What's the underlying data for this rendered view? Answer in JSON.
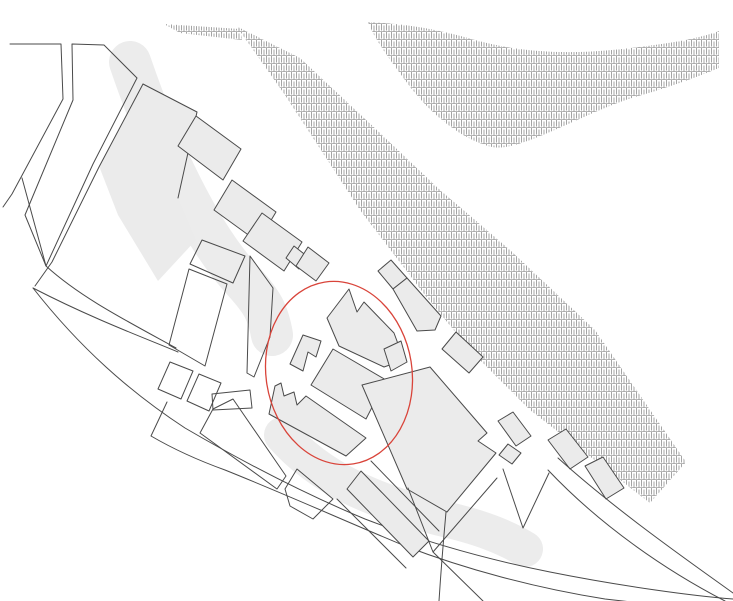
{
  "figure": {
    "kind": "architectural-site-plan",
    "canvas": {
      "width": 733,
      "height": 601
    },
    "colors": {
      "background": "#ffffff",
      "line": "#4a4a4a",
      "building_fill": "#ebebeb",
      "swath_fill": "#ececec",
      "hatch_stroke": "#8e8e8e",
      "hatch_row_stroke": "#9a9a9a",
      "highlight_stroke": "#d9443a"
    },
    "highlight_ellipse": {
      "cx": 339,
      "cy": 373,
      "rx": 73,
      "ry": 92,
      "rotation": -9
    },
    "shapes": [
      {
        "name": "soft-gray-swath-upper",
        "kind": "swath",
        "w": 42,
        "d": "M130,62 C160,150 200,235 245,283 C262,302 268,312 272,335"
      },
      {
        "name": "soft-gray-swath-lower",
        "kind": "swath",
        "w": 36,
        "d": "M282,435 C320,478 370,500 440,518 C480,527 505,537 525,549"
      },
      {
        "name": "gray-triangle-area",
        "kind": "shade",
        "d": "M143,84 L197,112 L178,198 L196,240 L158,281 L118,215 L99,166 Z"
      },
      {
        "name": "hatch-river-leaf",
        "kind": "hatch",
        "d": "M368,22 C410,24 440,30 475,40 C515,51 560,55 612,50 C660,45 695,40 719,31 L719,68 C690,80 660,90 635,97 C605,106 570,124 538,137 C515,146 500,150 488,146 C455,136 425,108 405,80 C390,60 375,40 368,22 Z"
      },
      {
        "name": "hatch-embankment-band",
        "kind": "hatch",
        "d": "M237,27 L285,95 L360,210 L425,295 L470,350 L530,410 L650,503 L686,462 L595,330 L510,250 L440,190 L380,133 L300,58 L240,28 Z"
      },
      {
        "name": "hatch-embankment-wisp",
        "kind": "hatch",
        "d": "M164,24 L240,29 L242,40 L180,33 Z"
      },
      {
        "name": "street-edge-topleft",
        "kind": "line",
        "d": "M10,44 L61,44 L63,99 L12,194 L3,207"
      },
      {
        "name": "block-topleft",
        "kind": "block",
        "d": "M72,44 L104,45 L137,78 L93,164 L46,266 L25,215 L73,100 Z"
      },
      {
        "name": "street-edge-diagonal-inner",
        "kind": "line",
        "d": "M143,84 L99,167 L52,262 L35,286"
      },
      {
        "name": "street-edge-gray-triangle",
        "kind": "line",
        "d": "M143,84 L197,112 L178,198"
      },
      {
        "name": "street-edge-crescent-north",
        "kind": "line",
        "d": "M22,178 L46,266 C80,297 125,320 176,348"
      },
      {
        "name": "crescent-top-edge",
        "kind": "line",
        "d": "M33,288 C95,320 150,340 178,352"
      },
      {
        "name": "district-outer-curve",
        "kind": "line",
        "d": "M33,288 C80,348 130,392 185,428 C245,463 305,494 365,519 C425,542 490,560 550,572 C620,586 693,596 733,599"
      },
      {
        "name": "curved-street-south-edge",
        "kind": "line",
        "d": "M167,402 L151,436 C175,450 200,461 225,470 C285,494 345,521 405,546 C465,569 535,588 605,599 L658,605"
      },
      {
        "name": "block-small-a",
        "kind": "block",
        "d": "M170,362 L193,371 L181,399 L158,389 Z"
      },
      {
        "name": "block-small-b",
        "kind": "block",
        "d": "M199,374 L221,383 L209,411 L187,401 Z"
      },
      {
        "name": "block-small-c",
        "kind": "block",
        "d": "M212,394 L250,390 L252,408 L213,410 Z"
      },
      {
        "name": "block-thin-strip",
        "kind": "block",
        "d": "M213,409 L233,399 L286,476 L277,489 L200,433 Z"
      },
      {
        "name": "block-quad-upper",
        "kind": "block",
        "d": "M202,240 L245,256 L233,283 L190,264 Z"
      },
      {
        "name": "block-quad-tall",
        "kind": "block",
        "d": "M189,269 L227,284 L205,366 L169,345 Z"
      },
      {
        "name": "block-sliver-pentagon",
        "kind": "block",
        "d": "M250,256 L273,288 L270,337 L254,377 L247,373 Z"
      },
      {
        "name": "block-notched-south",
        "kind": "block",
        "d": "M285,489 L297,469 L333,499 L323,509 L313,519 L290,506 Z"
      },
      {
        "name": "building-parallelogram-1",
        "kind": "building",
        "d": "M196,116 L241,149 L223,180 L178,146 Z"
      },
      {
        "name": "building-parallelogram-2",
        "kind": "building",
        "d": "M232,180 L276,212 L258,242 L214,210 Z"
      },
      {
        "name": "building-parallelogram-3",
        "kind": "building",
        "d": "M262,213 L302,242 L284,271 L243,241 Z"
      },
      {
        "name": "building-annex-square",
        "kind": "building",
        "d": "M294,246 L308,257 L299,269 L286,258 Z"
      },
      {
        "name": "building-diamond",
        "kind": "building",
        "d": "M308,247 L329,263 L316,281 L296,266 Z"
      },
      {
        "name": "building-strip-ne-1",
        "kind": "building",
        "d": "M378,271 L391,260 L407,278 L393,289 Z"
      },
      {
        "name": "building-strip-ne-2",
        "kind": "building",
        "d": "M393,289 L407,278 L441,316 L435,330 L417,331 Z"
      },
      {
        "name": "building-strip-ne-3",
        "kind": "building",
        "d": "M442,349 L456,332 L483,357 L469,373 Z"
      },
      {
        "name": "building-strip-ne-4",
        "kind": "building",
        "d": "M498,421 L513,412 L531,436 L516,446 Z"
      },
      {
        "name": "building-strip-ne-5",
        "kind": "building",
        "d": "M548,440 L566,429 L588,457 L570,469 Z"
      },
      {
        "name": "building-strip-ne-6",
        "kind": "building",
        "d": "M585,466 L603,457 L624,488 L606,499 Z"
      },
      {
        "name": "building-cluster-top",
        "kind": "building",
        "d": "M327,318 L349,289 L357,312 L364,302 L394,333 L404,360 L384,367 L339,346 Z"
      },
      {
        "name": "building-cluster-top-annex",
        "kind": "building",
        "d": "M384,349 L401,341 L407,362 L391,371 Z"
      },
      {
        "name": "building-cluster-left",
        "kind": "building",
        "d": "M290,364 L303,335 L321,341 L316,357 L308,352 L303,371 Z"
      },
      {
        "name": "building-cluster-mid",
        "kind": "building",
        "d": "M333,349 L386,380 L366,419 L311,385 Z"
      },
      {
        "name": "building-cluster-bottomleft",
        "kind": "building",
        "d": "M269,414 L275,386 L281,383 L284,396 L294,392 L297,405 L306,396 L366,438 L346,456 Z"
      },
      {
        "name": "building-large-southeast",
        "kind": "building",
        "d": "M362,385 L430,367 L487,433 L478,441 L496,453 L447,512 L407,489 Z"
      },
      {
        "name": "building-tiny-diamond",
        "kind": "building",
        "d": "M508,444 L521,453 L512,464 L499,455 Z"
      },
      {
        "name": "building-strip-south",
        "kind": "building",
        "d": "M347,489 L361,471 L429,541 L413,557 Z"
      },
      {
        "name": "street-edge-wedge-block",
        "kind": "line",
        "d": "M408,488 L433,552 L483,601 M433,552 L497,478"
      },
      {
        "name": "street-edge-below-cluster",
        "kind": "line",
        "d": "M446,512 C443,545 441,570 439,601"
      },
      {
        "name": "street-v-thin",
        "kind": "line",
        "d": "M503,469 L523,528 L549,473"
      },
      {
        "name": "street-edge-se-corner-1",
        "kind": "line",
        "d": "M548,470 C600,525 665,570 725,601"
      },
      {
        "name": "street-edge-se-corner-2",
        "kind": "line",
        "d": "M558,458 C618,512 690,562 733,593"
      },
      {
        "name": "street-edge-strip-ne",
        "kind": "line",
        "d": "M371,461 L439,531"
      },
      {
        "name": "street-edge-strip-sw",
        "kind": "line",
        "d": "M337,499 L406,568"
      }
    ]
  }
}
